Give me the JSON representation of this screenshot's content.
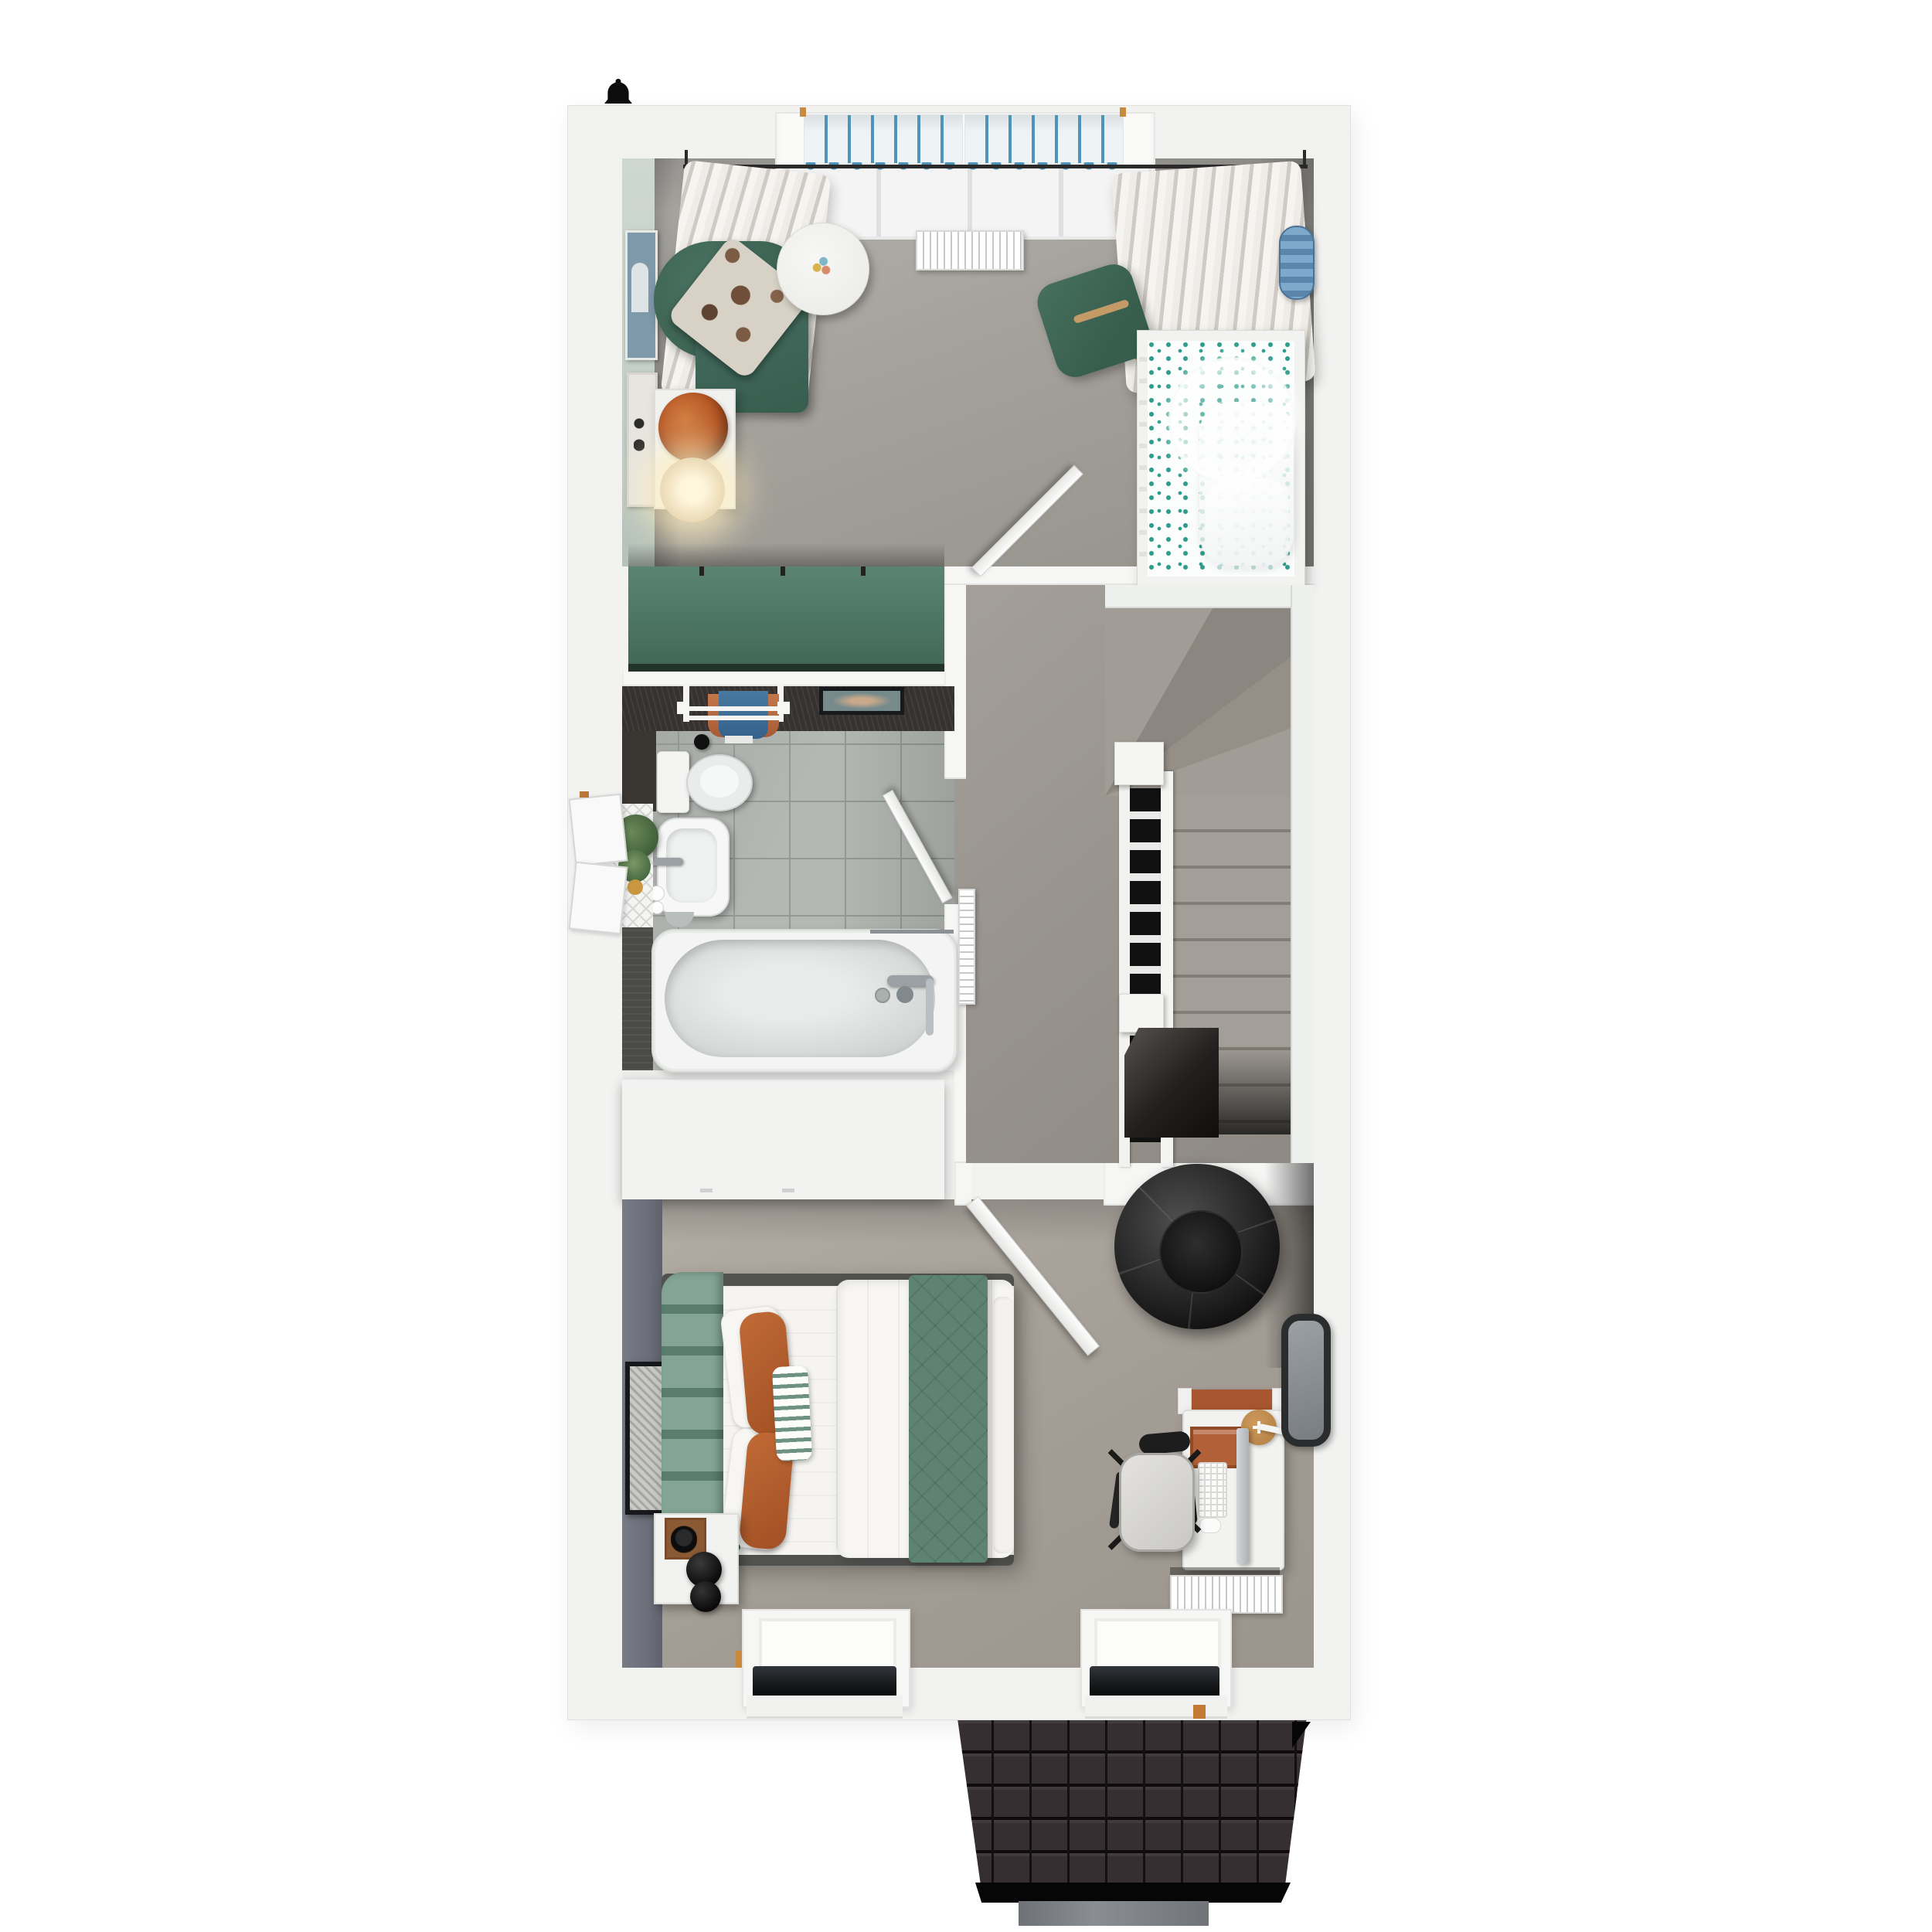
{
  "meta": {
    "title": "Upper-storey 3D floor plan render (top-down dollhouse view)",
    "view": "top-down",
    "visible_text": "none"
  },
  "palette": {
    "page_bg": "#ffffff",
    "wall": "#f2f2f1",
    "wall_white": "#f6f6f5",
    "mint_wall": "#c9d3cb",
    "accent_wall": "#70737d",
    "carpet_nursery": "#a3a09a",
    "carpet_landing": "#98938d",
    "carpet_bedroom": "#aaa49c",
    "tile": "#b4b8b4",
    "dark_wood": "#35322f",
    "charcoal": "#3c3f41",
    "teal": "#4e7a6b",
    "green_chair": "#3d6455",
    "green_throw": "#5e8274",
    "orange": "#b5612f",
    "blue_stripe": "#4f93b8",
    "towel_blue": "#3f6f9e",
    "pouf_blue": "#6f9ec4",
    "roof": "#362f32",
    "gutter": "#75797c"
  },
  "rooms": [
    {
      "id": "nursery",
      "label": "Nursery bedroom",
      "floor": "grey carpet",
      "furniture": [
        "bay window with blue striped roman blinds",
        "curtain rod with cream curtains (both sides)",
        "radiator under window",
        "green armchair with patterned cushion",
        "white side table with orange knot cushion and lit lamp",
        "round white play table with wooden toy",
        "green rocking chair",
        "white cot with polka-dot mattress and sheer canopy",
        "blue striped pouf",
        "mint feature wall with two art prints",
        "teal wardrobe along bottom wall",
        "open white door to landing"
      ]
    },
    {
      "id": "bathroom",
      "label": "Family bathroom",
      "floor": "grey stone tiles",
      "furniture": [
        "dark feature wall with towel ladder (blue and orange towels)",
        "framed wall print",
        "toilet with dark counter and toilet brush",
        "white basin with chrome tap, soaps and bin",
        "lattice windowsill with plants",
        "open casement window on left wall",
        "bathtub with shower screen, mixer tap and riser rail",
        "dark vanity strip",
        "open white door to landing"
      ]
    },
    {
      "id": "landing",
      "label": "Landing and staircase",
      "floor": "grey carpet",
      "furniture": [
        "winder staircase descending",
        "white balustrade with newel posts",
        "stairwell void",
        "wall radiator"
      ]
    },
    {
      "id": "bedroom",
      "label": "Main bedroom",
      "floor": "grey-beige carpet",
      "furniture": [
        "charcoal wardrobe unit",
        "double bed with green scalloped headboard",
        "white pillows, orange cushions, green striped cushion",
        "white duvet with green quilted throw runner",
        "bedside table with wooden tray, headphones and double-sphere black lamp",
        "dark accent wall with framed art",
        "black faceted bean bag",
        "desk with monitor, keyboard, mouse, orange organiser, round board and task lamp",
        "desk chair with black frame",
        "dark wall mirror",
        "radiator",
        "two dormer windows in bottom wall",
        "open white door to landing"
      ]
    },
    {
      "id": "exterior",
      "label": "Exterior",
      "furniture": [
        "black alarm-bell symbol on top wall",
        "dark shingled roof slope",
        "black fascia band",
        "grey gutter section"
      ]
    }
  ]
}
